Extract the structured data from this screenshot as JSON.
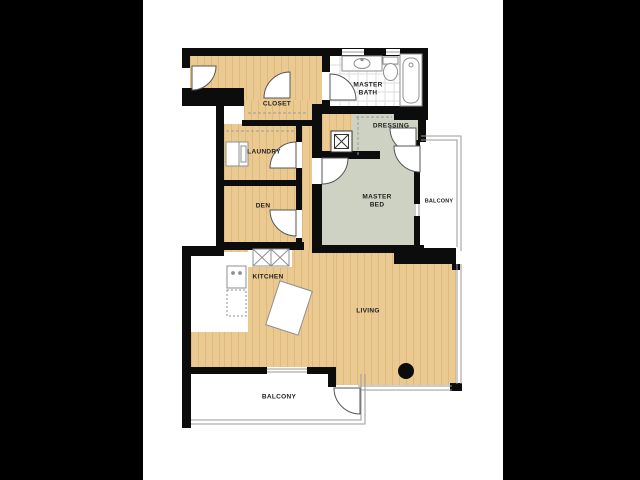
{
  "scene": {
    "description": "Apartment floor plan drawing on white page with black letterbox background",
    "background_color": "#000000",
    "page_color": "#ffffff"
  },
  "palette": {
    "wood_floor": "#ebca92",
    "carpet": "#cdd2c2",
    "wall": "#0c0c0c",
    "fixture_line": "#8f8f8f",
    "window_line": "#9a9a9a",
    "label_color": "#222222"
  },
  "labels": {
    "closet": "CLOSET",
    "master_bath_line1": "MASTER",
    "master_bath_line2": "BATH",
    "laundry": "LAUNDRY",
    "dressing": "DRESSING",
    "den": "DEN",
    "master_bed_line1": "MASTER",
    "master_bed_line2": "BED",
    "balcony_right": "BALCONY",
    "kitchen": "KITCHEN",
    "living": "LIVING",
    "balcony_bottom": "BALCONY"
  },
  "icons": {
    "vanity-sink-icon": "rect with oval basin",
    "toilet-icon": "tank rect with oval bowl",
    "bathtub-icon": "rect with inner rounded tub and drain",
    "washer-icon": "rect appliance in laundry",
    "range-burners-icon": "two crossed boxes",
    "kitchen-sink-icon": "rect with two dots",
    "dishwasher-icon": "dashed rect",
    "island-counter": "rotated white rectangle",
    "water-heater-icon": "double box with X",
    "column-marker": "solid black circle",
    "door-swing": "white quarter-circle pie",
    "window": "thin double parallel lines",
    "closet-rod": "dashed line"
  }
}
